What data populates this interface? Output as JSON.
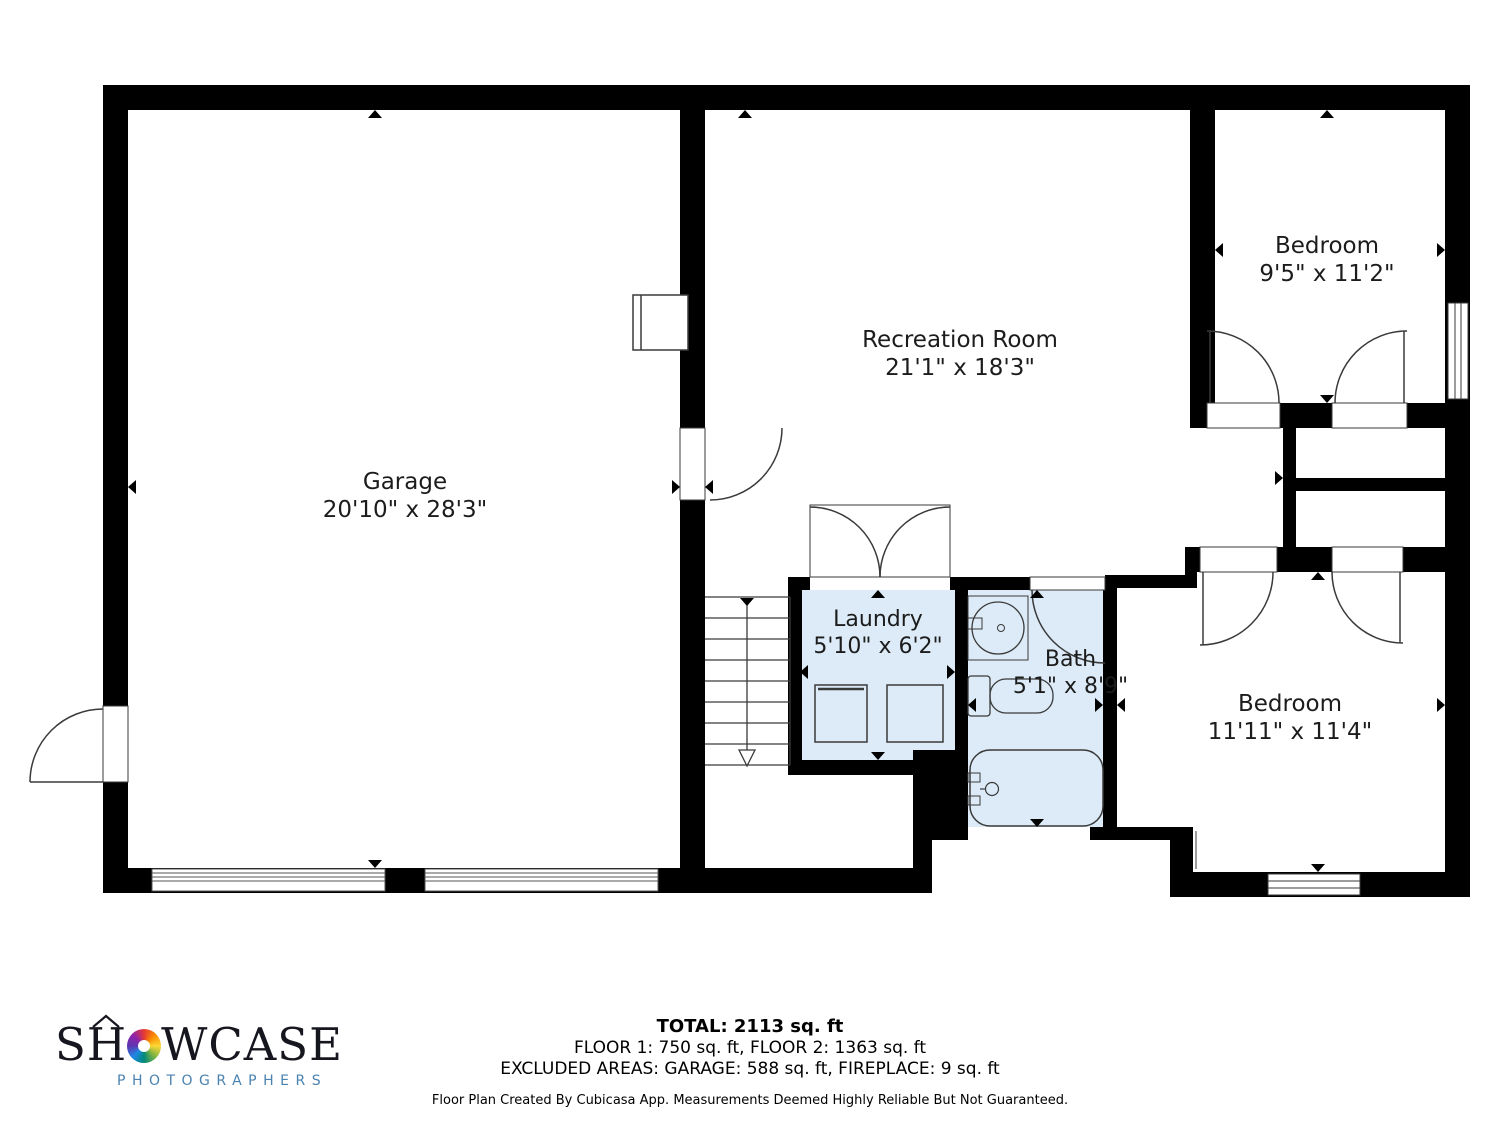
{
  "rooms": [
    {
      "name": "Garage",
      "dims": "20'10\" x 28'3\""
    },
    {
      "name": "Recreation Room",
      "dims": "21'1\" x 18'3\""
    },
    {
      "name": "Bedroom",
      "dims": "9'5\" x 11'2\""
    },
    {
      "name": "Laundry",
      "dims": "5'10\" x 6'2\""
    },
    {
      "name": "Bath",
      "dims": "5'1\" x 8'9\""
    },
    {
      "name": "Bedroom",
      "dims": "11'11\" x 11'4\""
    }
  ],
  "summary": {
    "total": "TOTAL: 2113 sq. ft",
    "floors": "FLOOR 1: 750 sq. ft, FLOOR 2: 1363 sq. ft",
    "excluded": "EXCLUDED AREAS: GARAGE: 588 sq. ft, FIREPLACE: 9 sq. ft",
    "disclaimer": "Floor Plan Created By Cubicasa App. Measurements Deemed Highly Reliable But Not Guaranteed."
  },
  "logo": {
    "brand_left": "SH",
    "brand_right": "WCASE",
    "subtitle": "PHOTOGRAPHERS"
  },
  "colors": {
    "wall": "#000000",
    "room_fill": "#dcebf7",
    "thin_line": "#3a3a3a",
    "logo_subtitle": "#4a82b0"
  }
}
